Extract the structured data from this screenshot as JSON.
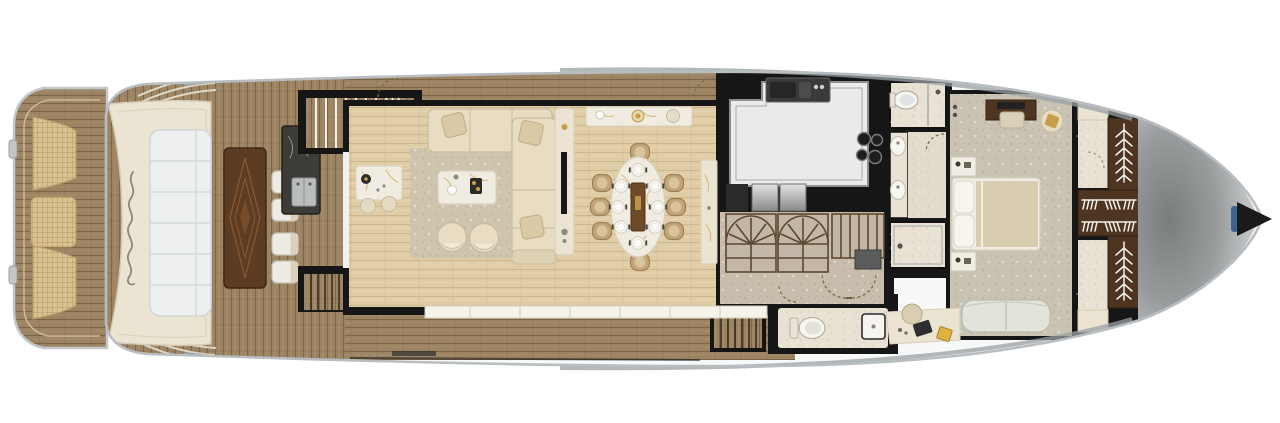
{
  "meta": {
    "title": "yacht-main-deck-floor-plan",
    "orientation": "bow-right-stern-left",
    "visible_text": []
  },
  "colors": {
    "background": "#ffffff",
    "hull_rim": "#b8bdc1",
    "hull_band": "#9aa0a3",
    "walls": "#161616",
    "teak_base": "#9c8462",
    "teak_seam": "#6e573c",
    "plank": "#e0cda6",
    "plank_seam": "#c3ac83",
    "wicker": "#d9c190",
    "wicker_line": "#b8996a",
    "cream_structure": "#ece4d3",
    "sunpad_white": "#edeff0",
    "rug": "#cfc5ae",
    "sofa_cream": "#e8ddc2",
    "sofa_stroke": "#c9bc9e",
    "pillow": "#d9c9a4",
    "marble_white": "#f1ece1",
    "gold_accent": "#c79f4a",
    "walnut_table": "#5d3c24",
    "dark_wood": "#4e3521",
    "rattan": "#c1a478",
    "island": "#ebebeb",
    "steel": "#bfbfbf",
    "stone": "#c8bdac",
    "carpet": "#cac2b3",
    "bath_floor": "#e9e2d4",
    "fixture_white": "#f8f6f1",
    "duvet": "#d8cdb0",
    "sofa_gray": "#e2e3da",
    "glazing": "#f6f3ea",
    "bow_tip": "#1a1a1a",
    "accent_blue": "#3d6390",
    "yellow_pad": "#ddb23e",
    "bar_marble": "#3e3c39"
  },
  "icons": [
    "transom-script-logo",
    "fishbone-hanging-rail-icon",
    "hanger-row-icon",
    "door-swing-arc",
    "stair-fan",
    "cooktop-burner-icon",
    "sink-icon",
    "toilet-icon",
    "shower-head-icon"
  ],
  "diagram_data": {
    "type": "floor-plan",
    "vessel_zones_stern_to_bow": [
      {
        "room": "swim-platform",
        "items": [
          "teak deck",
          "wicker hatch x3",
          "rail line",
          "cleats"
        ]
      },
      {
        "room": "aft-deck",
        "items": [
          "transom sofa with sunpad",
          "script logo",
          "walnut cocktail table",
          "white chair x4",
          "dark marble wet bar with sink",
          "corner steps port+starboard"
        ]
      },
      {
        "room": "salon",
        "items": [
          "flybridge staircase",
          "side locker",
          "L-shaped cream sofa",
          "throw pillow x4",
          "marble coffee table",
          "armchair x2",
          "area rug",
          "coffee bar with stool x2",
          "TV console"
        ]
      },
      {
        "room": "dining",
        "items": [
          "marble sideboard",
          "oval marble dining table",
          "table runner",
          "place setting x8",
          "rattan chair x8",
          "tall buffet cabinet"
        ]
      },
      {
        "room": "galley",
        "items": [
          "white island",
          "double sink",
          "4-burner cooktop",
          "stainless appliance x2",
          "dumbwaiter"
        ]
      },
      {
        "room": "foyer",
        "items": [
          "curved fan staircase x2",
          "straight stair run",
          "stone floor",
          "double door to master"
        ]
      },
      {
        "room": "day-head",
        "items": [
          "toilet",
          "square sink"
        ]
      },
      {
        "room": "master-bath",
        "items": [
          "WC-shower room",
          "double-sink vanity",
          "walk-in shower"
        ]
      },
      {
        "room": "master-cabin",
        "items": [
          "wall sconce x2",
          "TV console with bench",
          "armchair with gold pillow",
          "nightstand x2",
          "king bed with pillows and duvet",
          "loveseat",
          "vanity desk with chair, laptop, notepad"
        ]
      },
      {
        "room": "wardrobe",
        "items": [
          "walk-in closet floor x2",
          "hanging locker fishbone x2",
          "hanger row x2",
          "locker cabinet x2"
        ]
      },
      {
        "room": "bow",
        "items": [
          "moulded foredeck",
          "anchor pulpit tip",
          "blue accent"
        ]
      }
    ]
  }
}
